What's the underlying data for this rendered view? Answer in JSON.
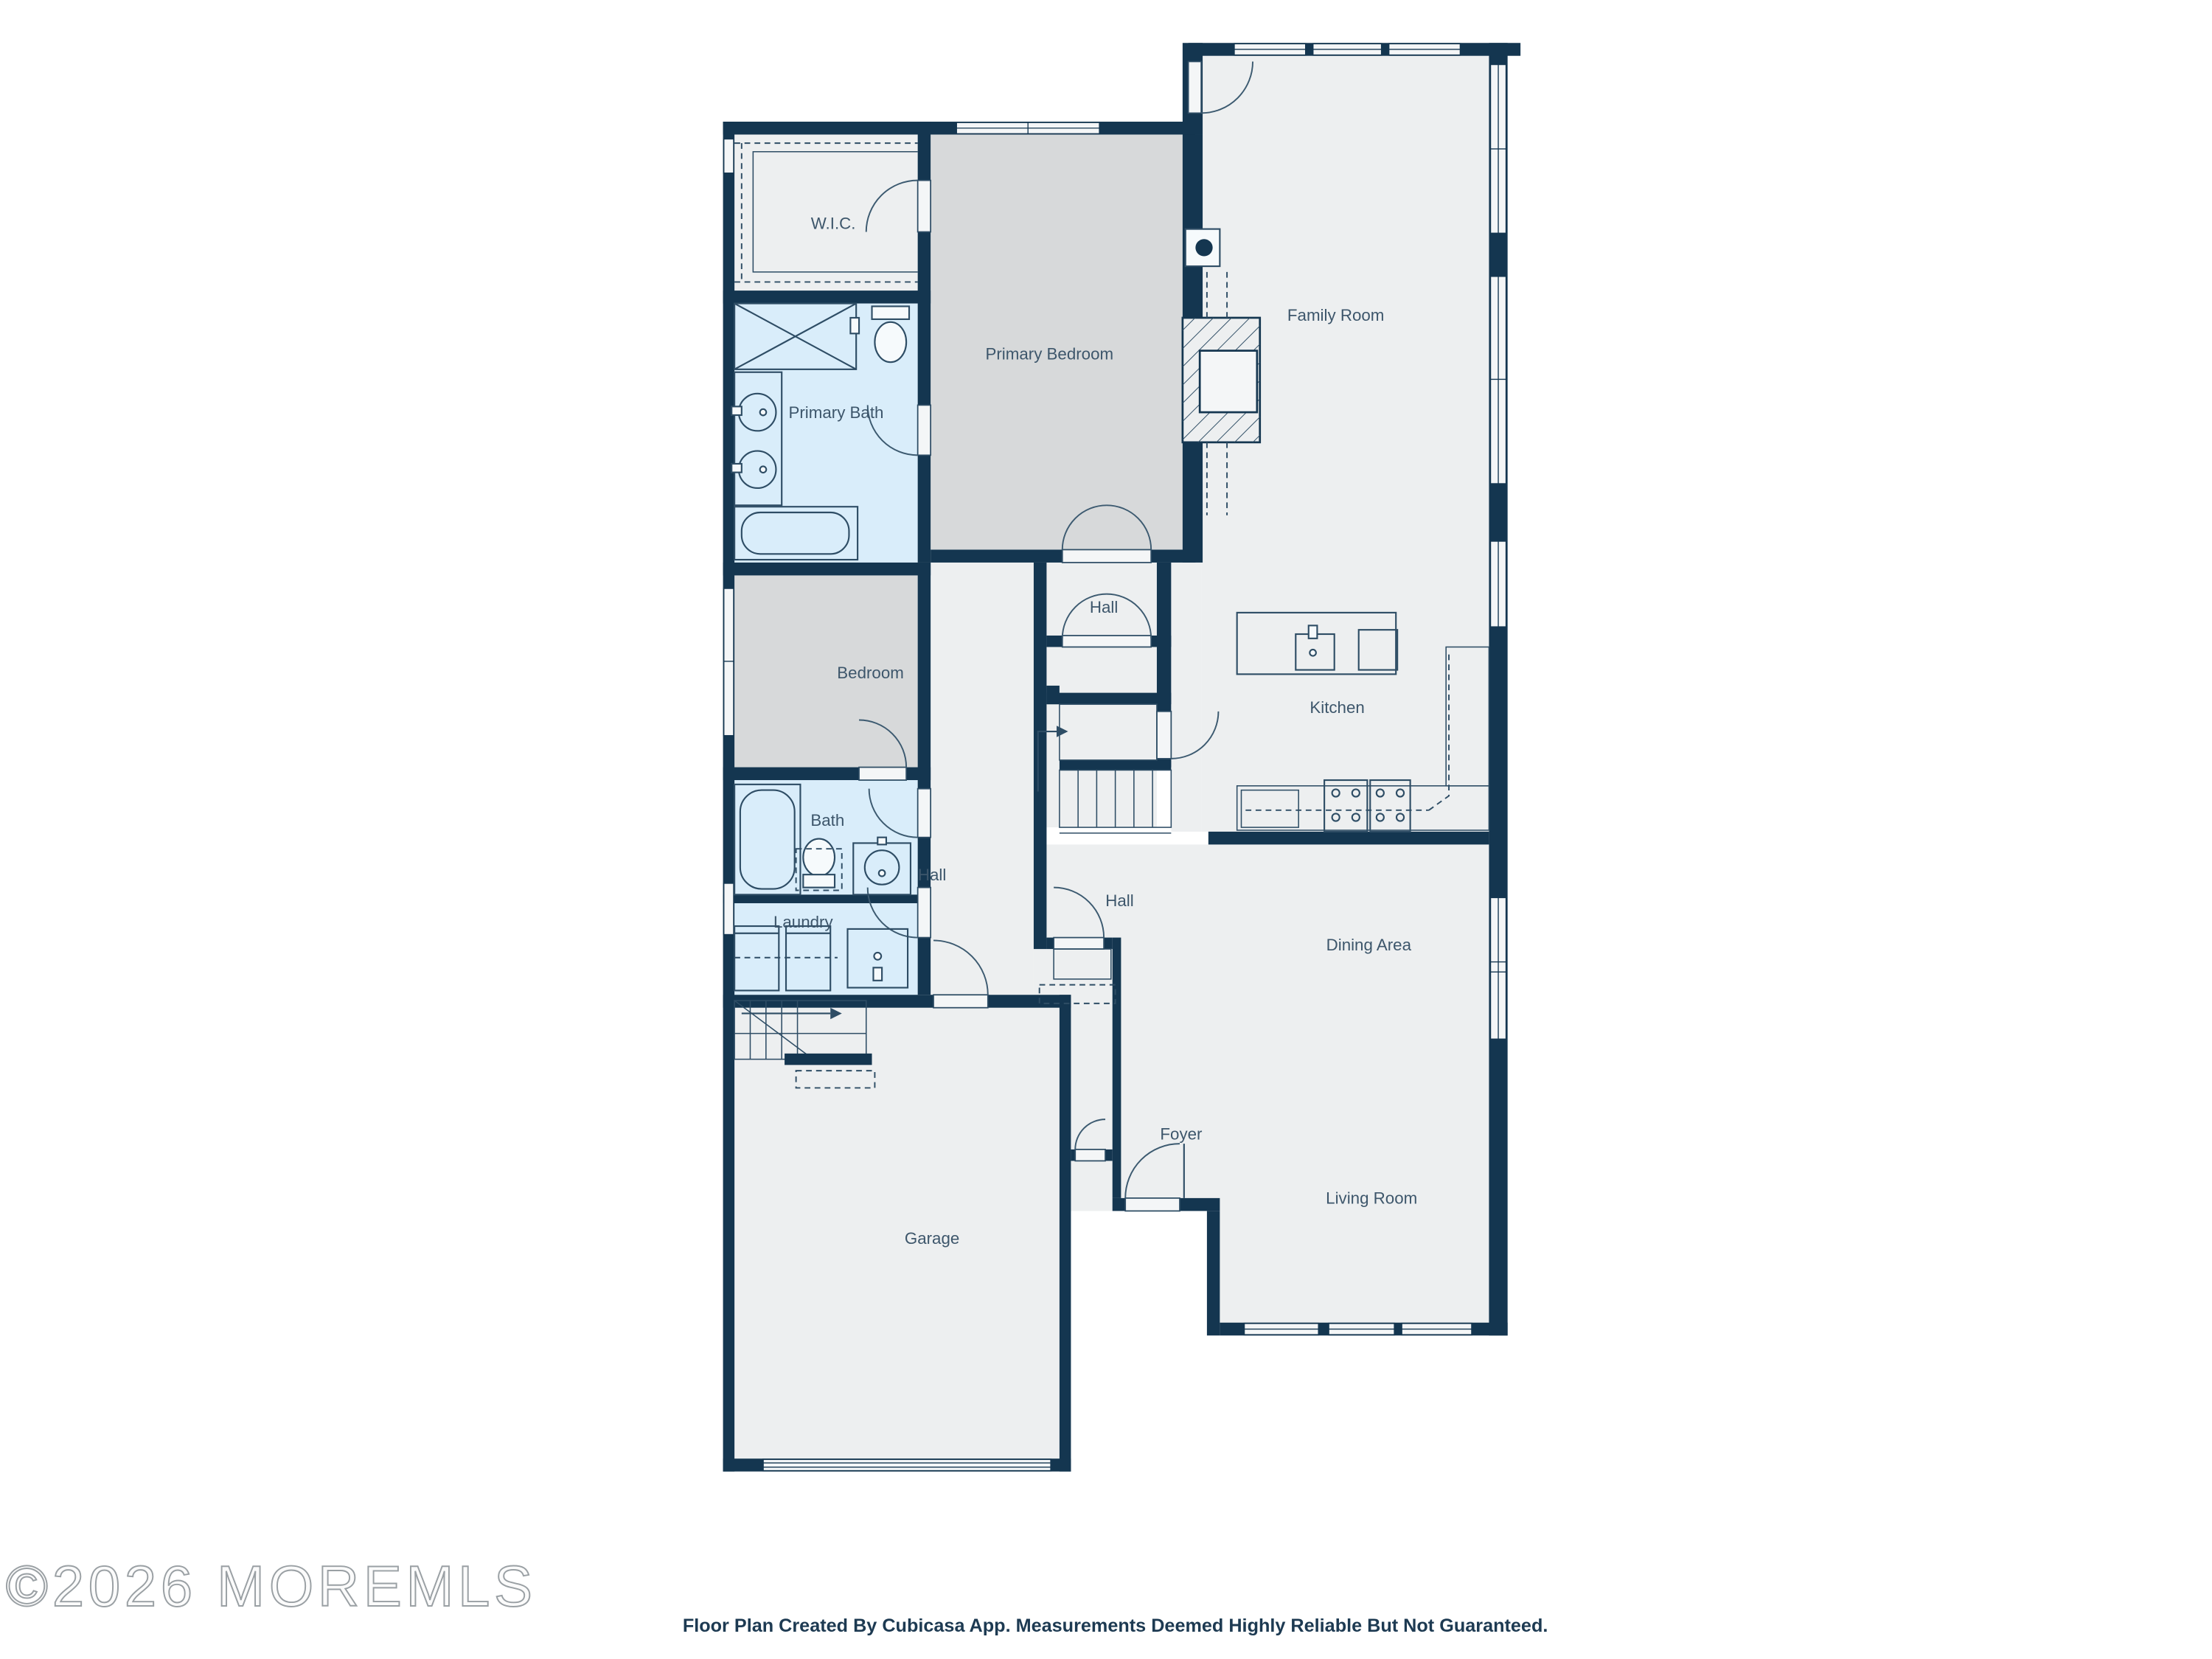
{
  "title": "Floor plan",
  "rooms": {
    "wic": {
      "label": "W.I.C."
    },
    "primary_bath": {
      "label": "Primary Bath"
    },
    "primary_bedroom": {
      "label": "Primary Bedroom"
    },
    "family_room": {
      "label": "Family Room"
    },
    "bedroom": {
      "label": "Bedroom"
    },
    "hall_upper": {
      "label": "Hall"
    },
    "kitchen": {
      "label": "Kitchen"
    },
    "bath": {
      "label": "Bath"
    },
    "hall_mid": {
      "label": "Hall"
    },
    "laundry": {
      "label": "Laundry"
    },
    "hall_lower": {
      "label": "Hall"
    },
    "dining_area": {
      "label": "Dining Area"
    },
    "foyer": {
      "label": "Foyer"
    },
    "living_room": {
      "label": "Living Room"
    },
    "garage": {
      "label": "Garage"
    }
  },
  "footer": {
    "text": "Floor Plan Created By Cubicasa App. Measurements Deemed Highly Reliable But Not Guaranteed."
  },
  "watermark": {
    "text": "©2026 MOREMLS"
  },
  "colors": {
    "wall": "#143650",
    "room_light": "#edeff0",
    "room_gray": "#d7d9da",
    "room_blue": "#d9edfa",
    "label": "#3d566b",
    "background": "#ffffff"
  }
}
